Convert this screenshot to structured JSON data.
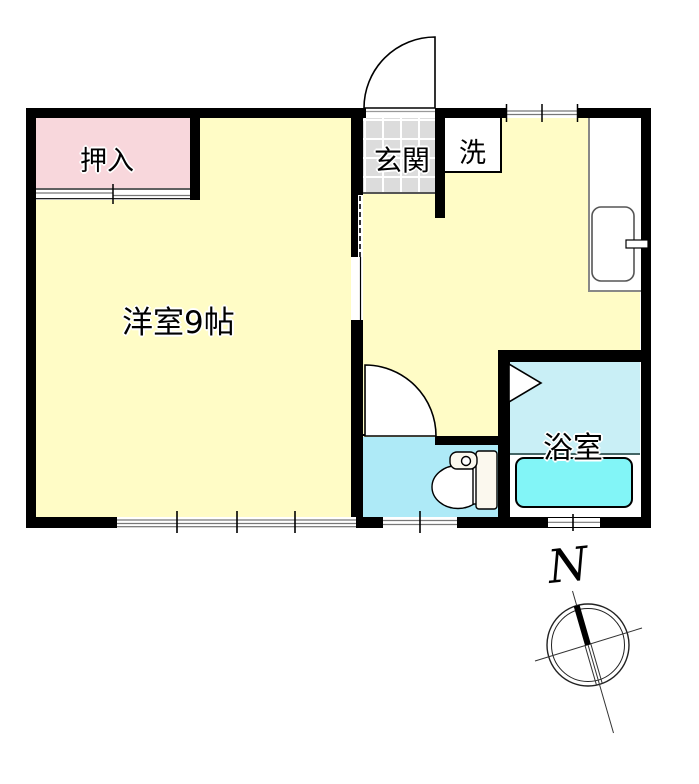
{
  "type": "floor_plan",
  "labels": {
    "closet": "押入",
    "western_room": "洋室9帖",
    "entrance": "玄関",
    "laundry": "洗",
    "bathroom": "浴室",
    "compass_north": "N"
  },
  "palette": {
    "room-yellow": "#FFFCC6",
    "closet-pink": "#F8D7DC",
    "genkan-gray": "#DCDCDC",
    "toilet-cyan": "#AEEAF7",
    "bath-cyan": "#C9EFF6",
    "bathtub-cyan": "#82F5F7",
    "wall-black": "#000000"
  }
}
